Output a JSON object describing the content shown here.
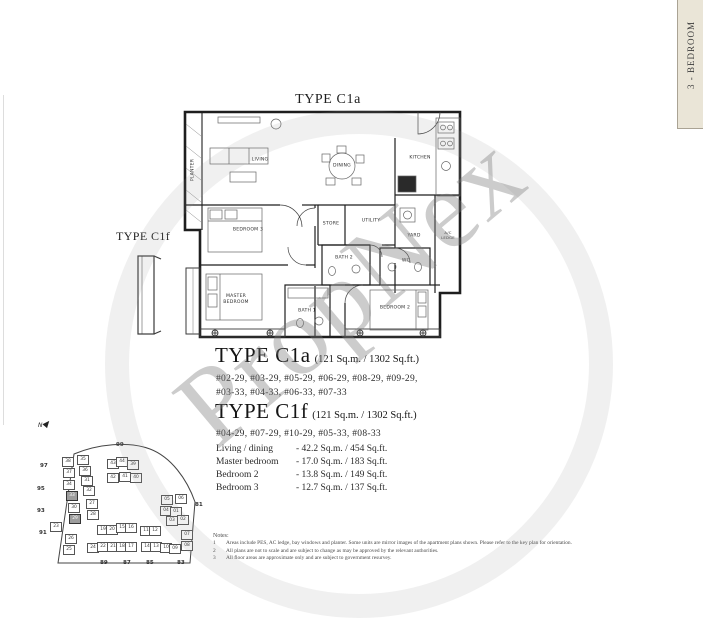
{
  "page": {
    "watermark": "PropNex",
    "tab_label": "3 - BEDROOM"
  },
  "floorplan": {
    "title_top": "TYPE C1a",
    "title_left": "TYPE C1f",
    "rooms": {
      "planter": "PLANTER",
      "living": "LIVING",
      "dining": "DINING",
      "kitchen": "KITCHEN",
      "store": "STORE",
      "utility": "UTILITY",
      "yard": "YARD",
      "ac_ledge": "A/C LEDGE",
      "bath2": "BATH 2",
      "wc": "WC",
      "bedroom3": "BEDROOM 3",
      "master_bedroom": "MASTER BEDROOM",
      "bath1": "BATH 1",
      "bedroom2": "BEDROOM 2"
    }
  },
  "types": [
    {
      "name": "TYPE C1a",
      "area": "(121 Sq.m. / 1302 Sq.ft.)",
      "units_lines": [
        "#02-29, #03-29, #05-29, #06-29, #08-29, #09-29,",
        "#03-33, #04-33, #06-33, #07-33"
      ]
    },
    {
      "name": "TYPE C1f",
      "area": "(121 Sq.m. / 1302 Sq.ft.)",
      "units_lines": [
        "#04-29, #07-29, #10-29, #05-33, #08-33"
      ]
    }
  ],
  "area_table": [
    {
      "label": "Living / dining",
      "value": "-  42.2 Sq.m. / 454 Sq.ft."
    },
    {
      "label": "Master bedroom",
      "value": "-  17.0 Sq.m. / 183 Sq.ft."
    },
    {
      "label": "Bedroom 2",
      "value": "-  13.8 Sq.m. / 149 Sq.ft."
    },
    {
      "label": "Bedroom 3",
      "value": "-  12.7 Sq.m. / 137 Sq.ft."
    }
  ],
  "keyplan": {
    "north_label": "N",
    "perimeter_labels": [
      {
        "t": "99",
        "x": 86,
        "y": 24
      },
      {
        "t": "97",
        "x": 10,
        "y": 45
      },
      {
        "t": "95",
        "x": 7,
        "y": 68
      },
      {
        "t": "93",
        "x": 7,
        "y": 90
      },
      {
        "t": "91",
        "x": 9,
        "y": 112
      },
      {
        "t": "81",
        "x": 165,
        "y": 84
      },
      {
        "t": "89",
        "x": 70,
        "y": 142
      },
      {
        "t": "87",
        "x": 93,
        "y": 142
      },
      {
        "t": "85",
        "x": 116,
        "y": 142
      },
      {
        "t": "83",
        "x": 147,
        "y": 142
      }
    ],
    "units": [
      {
        "n": "38",
        "x": 32,
        "y": 39
      },
      {
        "n": "35",
        "x": 47,
        "y": 37
      },
      {
        "n": "37",
        "x": 33,
        "y": 50
      },
      {
        "n": "36",
        "x": 49,
        "y": 48
      },
      {
        "n": "34",
        "x": 33,
        "y": 62
      },
      {
        "n": "31",
        "x": 51,
        "y": 58
      },
      {
        "n": "33",
        "x": 36,
        "y": 73,
        "hl": true
      },
      {
        "n": "32",
        "x": 53,
        "y": 68
      },
      {
        "n": "30",
        "x": 38,
        "y": 85
      },
      {
        "n": "27",
        "x": 56,
        "y": 81
      },
      {
        "n": "29",
        "x": 39,
        "y": 96,
        "hl": true
      },
      {
        "n": "28",
        "x": 57,
        "y": 92
      },
      {
        "n": "23",
        "x": 20,
        "y": 104
      },
      {
        "n": "26",
        "x": 35,
        "y": 116
      },
      {
        "n": "25",
        "x": 33,
        "y": 127
      },
      {
        "n": "24",
        "x": 57,
        "y": 125
      },
      {
        "n": "22",
        "x": 67,
        "y": 124
      },
      {
        "n": "21",
        "x": 77,
        "y": 124
      },
      {
        "n": "18",
        "x": 86,
        "y": 124
      },
      {
        "n": "17",
        "x": 95,
        "y": 124
      },
      {
        "n": "14",
        "x": 111,
        "y": 124
      },
      {
        "n": "13",
        "x": 120,
        "y": 124
      },
      {
        "n": "10",
        "x": 130,
        "y": 125
      },
      {
        "n": "09",
        "x": 139,
        "y": 126
      },
      {
        "n": "19",
        "x": 67,
        "y": 107
      },
      {
        "n": "20",
        "x": 76,
        "y": 107
      },
      {
        "n": "15",
        "x": 86,
        "y": 105
      },
      {
        "n": "16",
        "x": 95,
        "y": 105
      },
      {
        "n": "11",
        "x": 110,
        "y": 108
      },
      {
        "n": "12",
        "x": 119,
        "y": 108
      },
      {
        "n": "43",
        "x": 77,
        "y": 41
      },
      {
        "n": "44",
        "x": 86,
        "y": 39
      },
      {
        "n": "39",
        "x": 97,
        "y": 42
      },
      {
        "n": "42",
        "x": 77,
        "y": 55
      },
      {
        "n": "41",
        "x": 89,
        "y": 54
      },
      {
        "n": "40",
        "x": 100,
        "y": 55
      },
      {
        "n": "05",
        "x": 131,
        "y": 77
      },
      {
        "n": "06",
        "x": 145,
        "y": 76
      },
      {
        "n": "04",
        "x": 130,
        "y": 88
      },
      {
        "n": "01",
        "x": 140,
        "y": 89
      },
      {
        "n": "03",
        "x": 136,
        "y": 98
      },
      {
        "n": "02",
        "x": 147,
        "y": 97
      },
      {
        "n": "07",
        "x": 151,
        "y": 112
      },
      {
        "n": "08",
        "x": 151,
        "y": 123
      }
    ]
  },
  "notes": {
    "title": "Notes:",
    "items": [
      {
        "n": "1",
        "text": "Areas include PES, AC ledge, bay windows and planter. Some units are mirror images of the apartment plans shown. Please refer to the key plan for orientation."
      },
      {
        "n": "2",
        "text": "All plans are not to scale and are subject to change as may be approved by the relevant authorities."
      },
      {
        "n": "3",
        "text": "All floor areas are approximate only and are subject to government resurvey."
      }
    ]
  }
}
